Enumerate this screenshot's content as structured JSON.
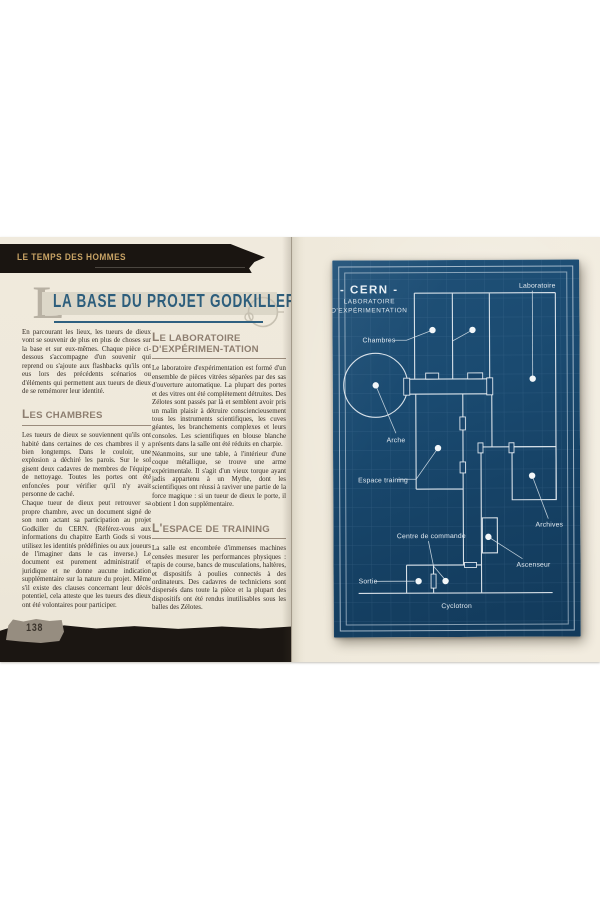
{
  "page": {
    "banner": "LE TEMPS DES HOMMES",
    "title": "LA BASE DU PROJET GODKILLER",
    "dropcap": "L",
    "page_number": "138"
  },
  "left": {
    "intro": "En parcourant les lieux, les tueurs de dieux vont se souvenir de plus en plus de choses sur la base et sur eux-mêmes. Chaque pièce ci-dessous s'accompagne d'un souvenir qui reprend ou s'ajoute aux flashbacks qu'ils ont eus lors des précédents scénarios ou d'éléments qui permettent aux tueurs de dieux de se remémorer leur identité.",
    "sections": [
      {
        "heading": "LES CHAMBRES",
        "paras": [
          "Les tueurs de dieux se souviennent qu'ils ont habité dans certaines de ces chambres il y a bien longtemps. Dans le couloir, une explosion a déchiré les parois. Sur le sol gisent deux cadavres de membres de l'équipe de nettoyage. Toutes les portes ont été enfoncées pour vérifier qu'il n'y avait personne de caché.",
          "Chaque tueur de dieux peut retrouver sa propre chambre, avec un document signé de son nom actant sa participation au projet Godkiller du CERN. (Référez-vous aux informations du chapitre Earth Gods si vous utilisez les identités prédéfinies ou aux joueurs de l'imaginer dans le cas inverse.) Le document est purement administratif et juridique et ne donne aucune indication supplémentaire sur la nature du projet. Même s'il existe des clauses concernant leur décès potentiel, cela atteste que les tueurs des dieux ont été volontaires pour participer."
        ]
      },
      {
        "heading": "LE LABORATOIRE D'EXPÉRIMEN-TATION",
        "paras": [
          "Le laboratoire d'expérimentation est formé d'un ensemble de pièces vitrées séparées par des sas d'ouverture automatique. La plupart des portes et des vitres ont été complètement détruites. Des Zélotes sont passés par là et semblent avoir pris un malin plaisir à détruire consciencieusement tous les instruments scientifiques, les cuves géantes, les branchements complexes et leurs consoles. Les scientifiques en blouse blanche présents dans la salle ont été réduits en charpie.",
          "Néanmoins, sur une table, à l'intérieur d'une coque métallique, se trouve une arme expérimentale. Il s'agit d'un vieux torque ayant jadis appartenu à un Mythe, dont les scientifiques ont réussi à raviver une partie de la force magique : si un tueur de dieux le porte, il obtient 1 don supplémentaire."
        ]
      },
      {
        "heading": "L'ESPACE DE TRAINING",
        "paras": [
          "La salle est encombrée d'immenses machines censées mesurer les performances physiques : tapis de course, bancs de musculations, haltères, et dispositifs à poulies connectés à des ordinateurs. Des cadavres de techniciens sont dispersés dans toute la pièce et la plupart des dispositifs ont été rendus inutilisables sous les balles des Zélotes."
        ]
      }
    ]
  },
  "blueprint": {
    "title": "- CERN -",
    "subtitle1": "LABORATOIRE",
    "subtitle2": "D'EXPÉRIMENTATION",
    "labels": {
      "laboratoire": "Laboratoire",
      "chambres": "Chambres",
      "arche": "Arche",
      "espace_training": "Espace training",
      "archives": "Archives",
      "centre_de_commande": "Centre de commande",
      "ascenseur": "Ascenseur",
      "sortie": "Sortie",
      "cyclotron": "Cyclotron"
    }
  },
  "colors": {
    "paper": "#efe9dc",
    "banner_black": "#1a1511",
    "banner_gold": "#c8a365",
    "title_blue": "#2d5e7c",
    "heading_taupe": "#8d7e70",
    "blueprint_bg": "#1a4a70",
    "blueprint_line": "#e8eef3"
  }
}
